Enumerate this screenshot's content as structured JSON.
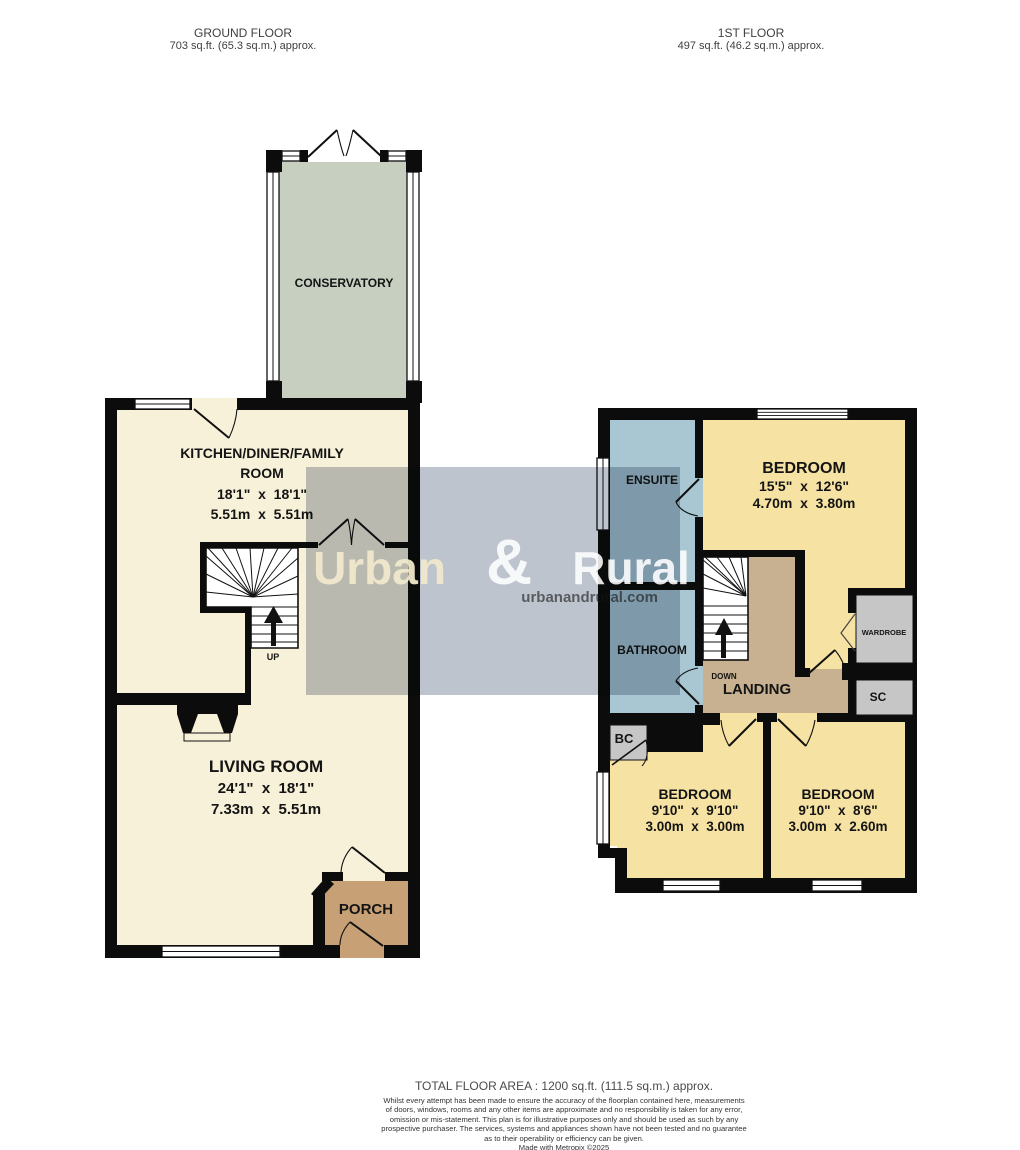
{
  "ground_floor_header": {
    "title": "GROUND FLOOR",
    "area": "703 sq.ft. (65.3 sq.m.) approx."
  },
  "first_floor_header": {
    "title": "1ST FLOOR",
    "area": "497 sq.ft. (46.2 sq.m.) approx."
  },
  "ground_floor": {
    "conservatory": {
      "name": "CONSERVATORY"
    },
    "kitchen": {
      "name_line1": "KITCHEN/DINER/FAMILY",
      "name_line2": "ROOM",
      "dims_imperial": "18'1\"  x  18'1\"",
      "dims_metric": "5.51m  x  5.51m"
    },
    "living_room": {
      "name": "LIVING ROOM",
      "dims_imperial": "24'1\"  x  18'1\"",
      "dims_metric": "7.33m  x  5.51m"
    },
    "porch": {
      "name": "PORCH"
    },
    "stairs": {
      "direction_label": "UP"
    }
  },
  "first_floor": {
    "bedroom_1": {
      "name": "BEDROOM",
      "dims_imperial": "15'5\"  x  12'6\"",
      "dims_metric": "4.70m  x  3.80m"
    },
    "bedroom_2": {
      "name": "BEDROOM",
      "dims_imperial": "9'10\"  x  9'10\"",
      "dims_metric": "3.00m  x  3.00m"
    },
    "bedroom_3": {
      "name": "BEDROOM",
      "dims_imperial": "9'10\"  x  8'6\"",
      "dims_metric": "3.00m  x  2.60m"
    },
    "ensuite": {
      "name": "ENSUITE"
    },
    "bathroom": {
      "name": "BATHROOM"
    },
    "landing": {
      "name": "LANDING"
    },
    "wardrobe": {
      "name": "WARDROBE"
    },
    "store_cupboard": {
      "name": "SC"
    },
    "boiler_cupboard": {
      "name": "BC"
    },
    "stairs": {
      "direction_label": "DOWN"
    }
  },
  "watermark": {
    "brand_first": "Urban",
    "brand_ampersand": "&",
    "brand_second": "Rural",
    "website": "urbanandrural.com"
  },
  "footer": {
    "total_area": "TOTAL FLOOR AREA : 1200 sq.ft. (111.5 sq.m.) approx.",
    "disclaimer_lines": [
      "Whilst every attempt has been made to ensure the accuracy of the floorplan contained here, measurements",
      "of doors, windows, rooms and any other items are approximate and no responsibility is taken for any error,",
      "omission or mis-statement. This plan is for illustrative purposes only and should be used as such by any",
      "prospective purchaser. The services, systems and appliances shown have not been tested and no guarantee",
      "as to their operability or efficiency can be given."
    ],
    "credit": "Made with Metropix ©2025"
  },
  "colors": {
    "wall": "#0c0c0c",
    "room_cream": "#f8f1d9",
    "conservatory_green": "#c7cfc1",
    "bedroom_yellow": "#f6e2a2",
    "bath_blue": "#a8c7d3",
    "landing_tan": "#c8b190",
    "porch_brown": "#c7a076",
    "closet_grey": "#c6c6c6",
    "watermark_grey": "#b9c0ca",
    "watermark_cream": "#f0e8cb"
  }
}
